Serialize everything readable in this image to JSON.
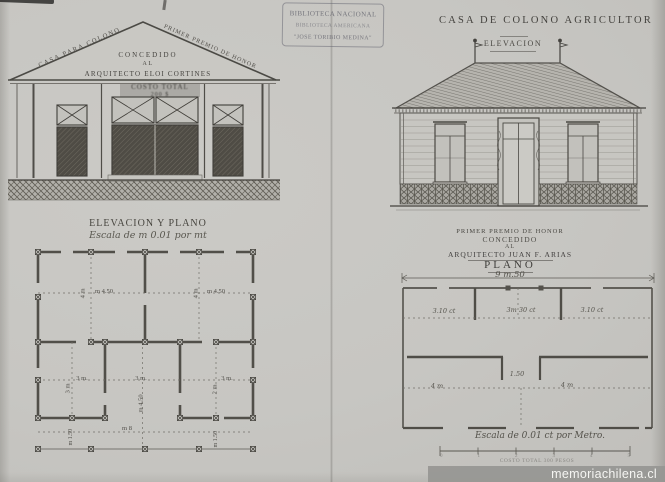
{
  "stamp": {
    "line1": "BIBLIOTECA NACIONAL",
    "line2": "BIBLIOTECA AMERICANA",
    "line3": "\"JOSE TORIBIO MEDINA\""
  },
  "left_sheet": {
    "roof_left_label": "CASA PARA COLONO",
    "roof_right_label": "PRIMER PREMIO DE HONOR",
    "award_line1": "CONCEDIDO",
    "award_line2": "AL",
    "award_line3": "ARQUITECTO ELOI CORTINES",
    "sign_line1": "COSTO TOTAL",
    "sign_line2": "200 $",
    "section_title": "ELEVACION Y PLANO",
    "scale_note": "Escala de m 0.01 por mt",
    "plan": {
      "room1_height": "4 m",
      "room1_width": "m 4.50",
      "room2_height": "4 m",
      "room2_width": "m 4.50",
      "room3_width": "3 m.",
      "room3_height": "3 m",
      "hall_width": "3 m.",
      "hall_height": "m 4.50",
      "room4_width": "3 m.",
      "room4_height": "2 m",
      "overall_width": "m 8",
      "porch_left": "m 1.50",
      "porch_right": "m 1.50"
    }
  },
  "right_sheet": {
    "title": "CASA DE COLONO AGRICULTOR",
    "elevation_label": "ELEVACION",
    "award_line1": "PRIMER PREMIO DE HONOR",
    "award_line2": "CONCEDIDO",
    "award_line3": "AL",
    "award_line4": "ARQUITECTO JUAN F. ARIAS",
    "plan_label": "PLANO",
    "overall_width": "9 m.50",
    "plan": {
      "dim_left": "3.10 ct",
      "dim_center": "3m 30 ct",
      "dim_right": "3.10 ct",
      "dim_room_left": "4 m",
      "dim_door": "1.50",
      "dim_room_right": "4 m"
    },
    "scale_note": "Escala de 0.01 ct por Metro.",
    "scale_ticks": [
      "0",
      "1",
      "2",
      "3",
      "4",
      "5"
    ],
    "cost_note": "COSTO TOTAL 300 PESOS"
  },
  "watermark": "memoriachilena.cl"
}
